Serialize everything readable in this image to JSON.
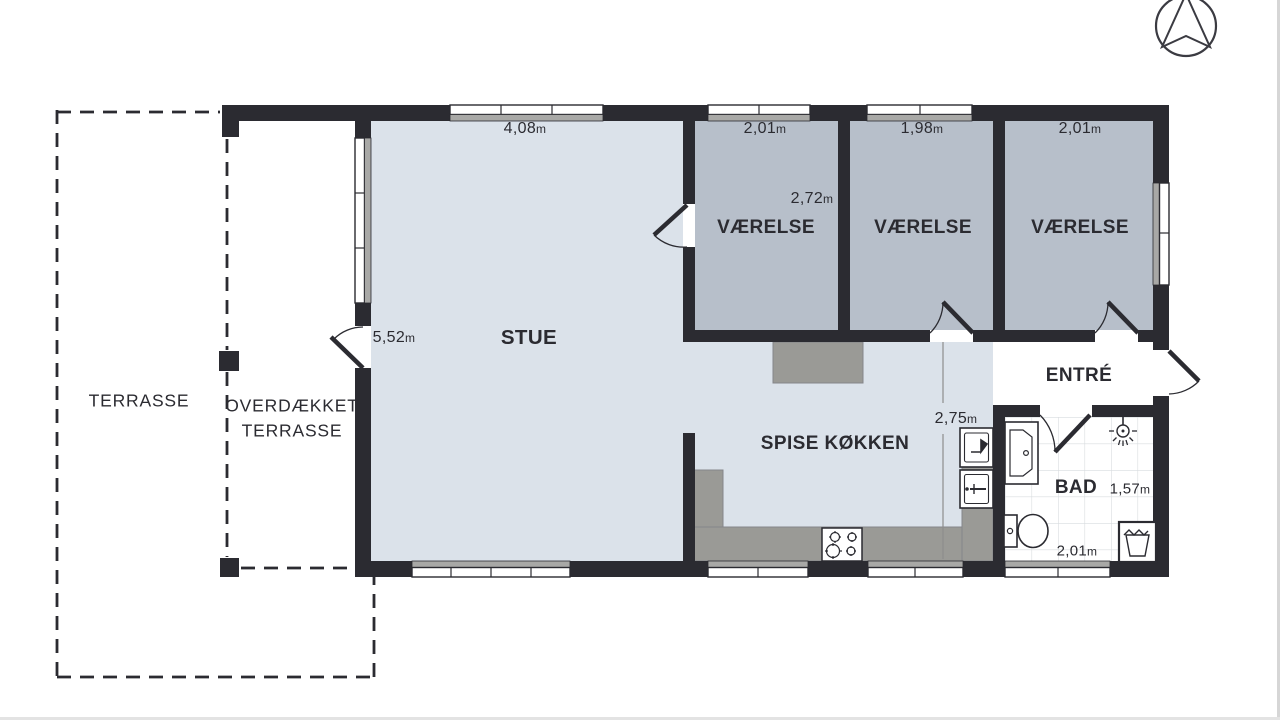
{
  "plan_title": "floor-plan",
  "palette": {
    "wall": "#2b2b31",
    "floor_living": "#dbe2ea",
    "floor_bedroom": "#b7bfca",
    "counter_gray": "#9a9a96",
    "window_sill": "#a8a8a6",
    "tile_line": "#d8dcdf",
    "dim_line": "#8d8d8d"
  },
  "labels": {
    "terrasse": "TERRASSE",
    "overdaekket_line1": "OVERDÆKKET",
    "overdaekket_line2": "TERRASSE",
    "stue": "STUE",
    "vaerelse_1": "VÆRELSE",
    "vaerelse_2": "VÆRELSE",
    "vaerelse_3": "VÆRELSE",
    "spise_koekken": "SPISE KØKKEN",
    "entre": "ENTRÉ",
    "bad": "BAD"
  },
  "dimensions": {
    "stue_width": "4,08m",
    "stue_depth": "5,52m",
    "vaerelse_1_width": "2,01m",
    "vaerelse_1_depth": "2,72m",
    "vaerelse_2_width": "1,98m",
    "vaerelse_3_width": "2,01m",
    "koekken_depth": "2,75m",
    "bad_depth": "1,57m",
    "bad_width": "2,01m"
  },
  "icons": {
    "compass": "north-arrow"
  }
}
